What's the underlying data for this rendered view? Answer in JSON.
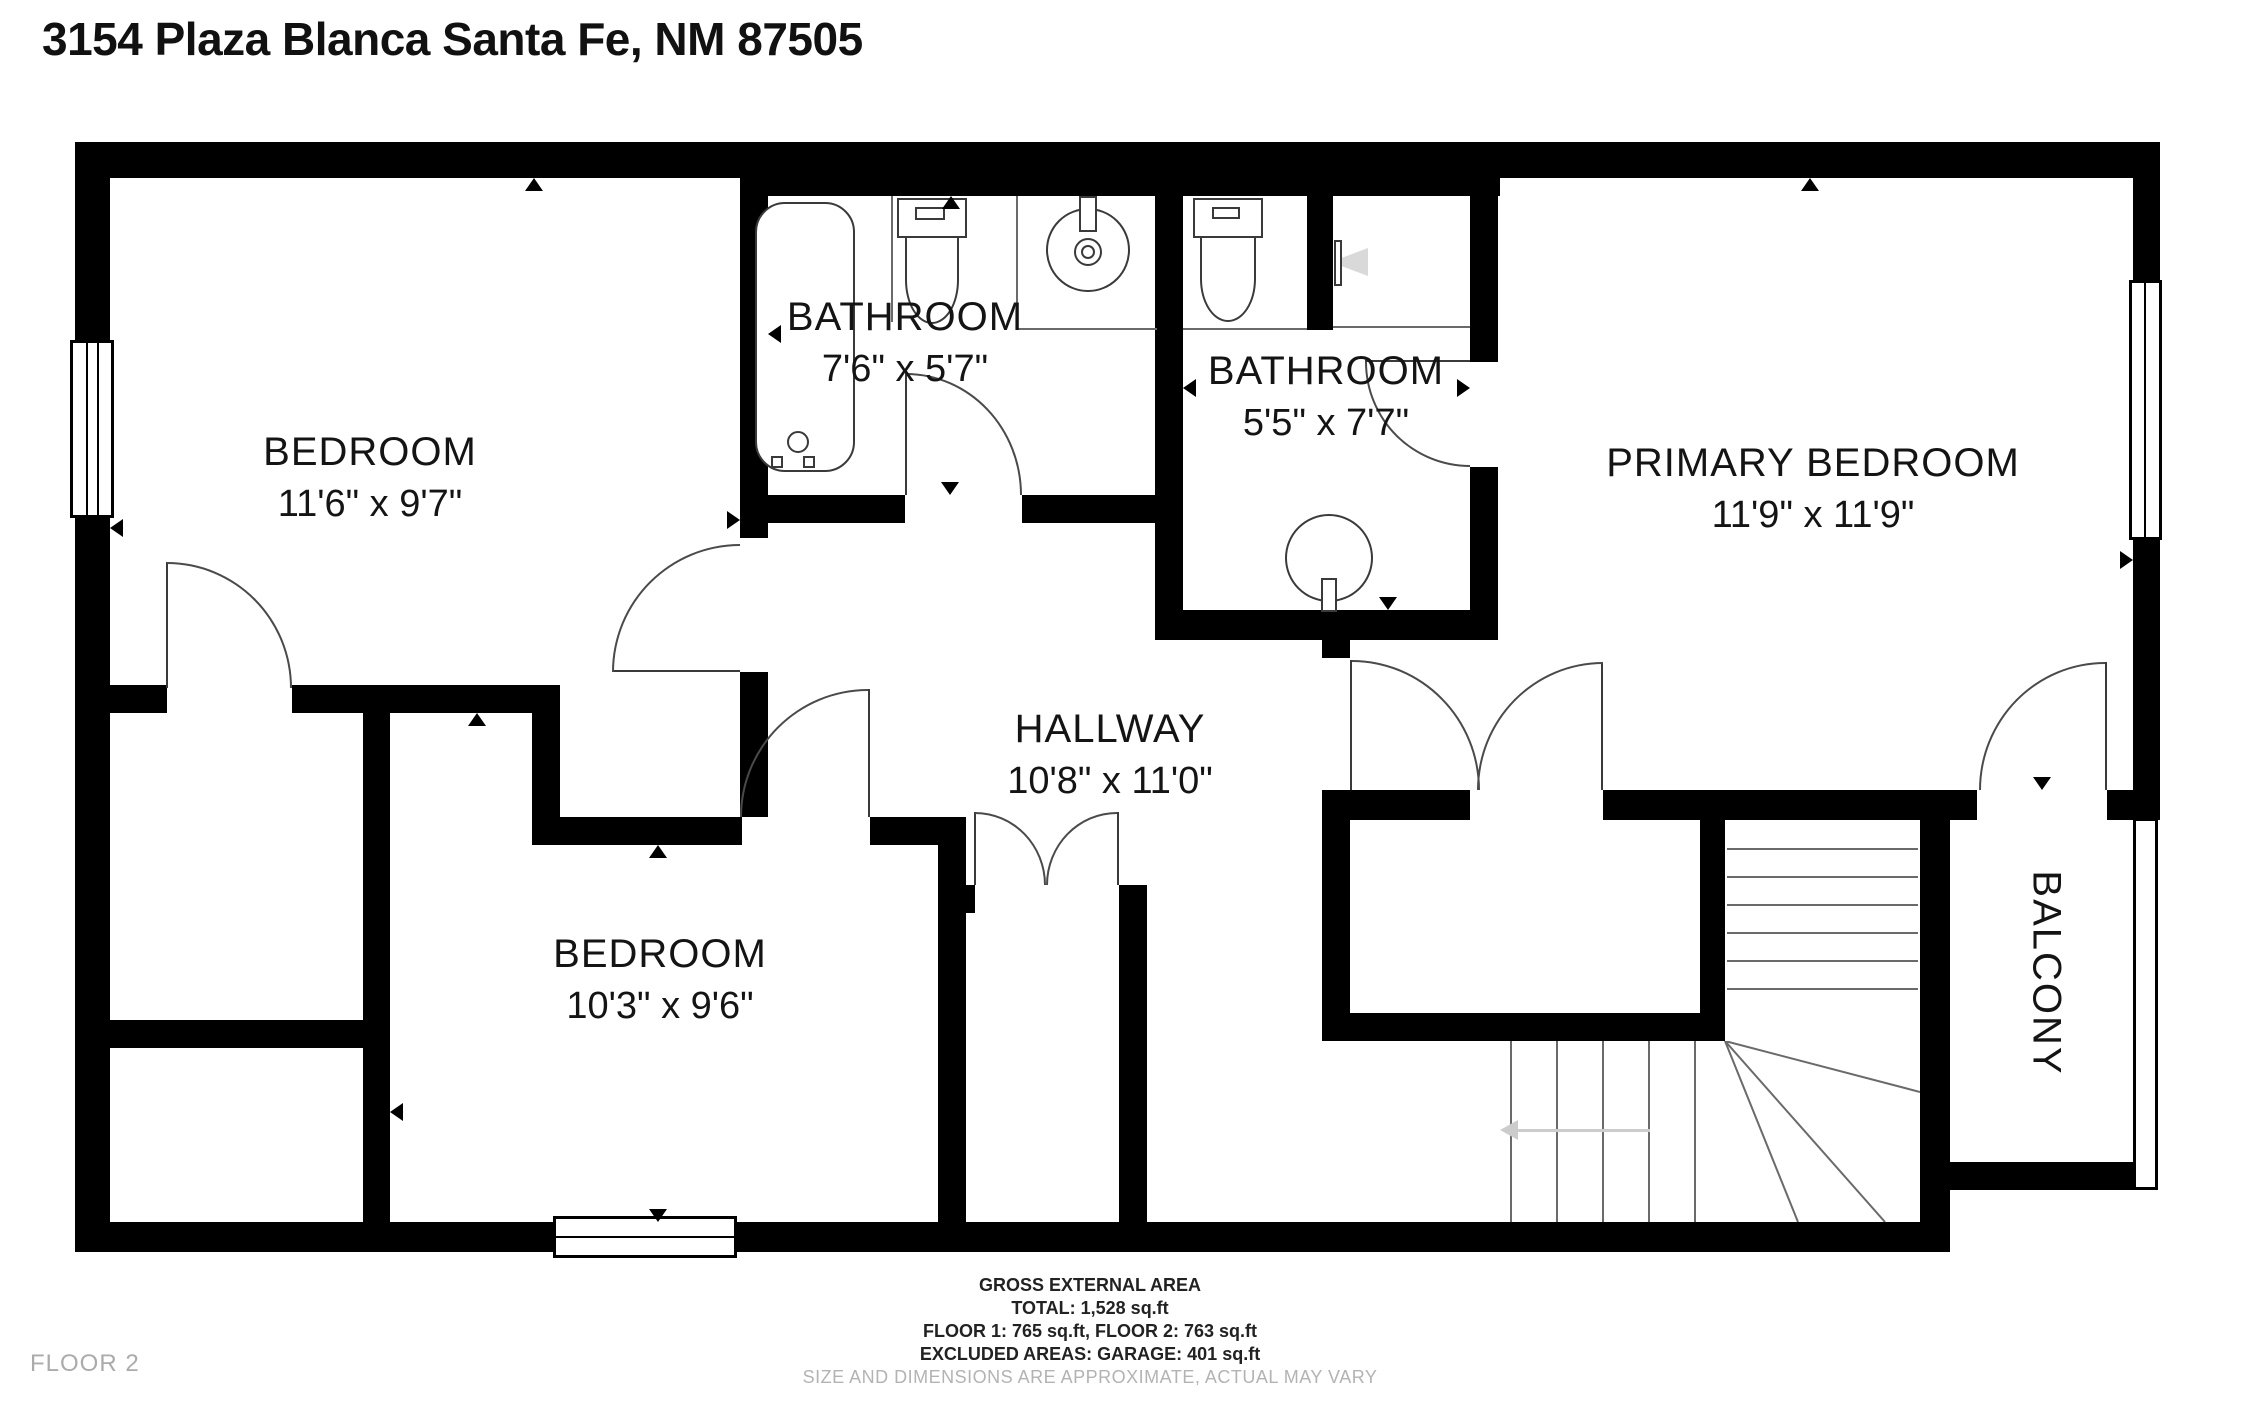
{
  "title": "3154 Plaza Blanca Santa Fe, NM 87505",
  "floor_label": "FLOOR 2",
  "rooms": [
    {
      "name": "BEDROOM",
      "dims": "11'6\" x 9'7\""
    },
    {
      "name": "BATHROOM",
      "dims": "7'6\" x 5'7\""
    },
    {
      "name": "BATHROOM",
      "dims": "5'5\" x 7'7\""
    },
    {
      "name": "PRIMARY BEDROOM",
      "dims": "11'9\" x 11'9\""
    },
    {
      "name": "HALLWAY",
      "dims": "10'8\" x 11'0\""
    },
    {
      "name": "BEDROOM",
      "dims": "10'3\" x 9'6\""
    },
    {
      "name": "BALCONY",
      "dims": ""
    }
  ],
  "footer": {
    "line1": "GROSS EXTERNAL AREA",
    "line2": "TOTAL: 1,528 sq.ft",
    "line3": "FLOOR 1: 765 sq.ft, FLOOR 2: 763 sq.ft",
    "line4": "EXCLUDED AREAS: GARAGE: 401 sq.ft",
    "disclaimer": "SIZE AND DIMENSIONS ARE APPROXIMATE, ACTUAL MAY VARY"
  },
  "colors": {
    "wall": "#000000",
    "line": "#3a3a3a",
    "label": "#141414",
    "muted": "#ababab",
    "arrow": "#cccccc"
  }
}
